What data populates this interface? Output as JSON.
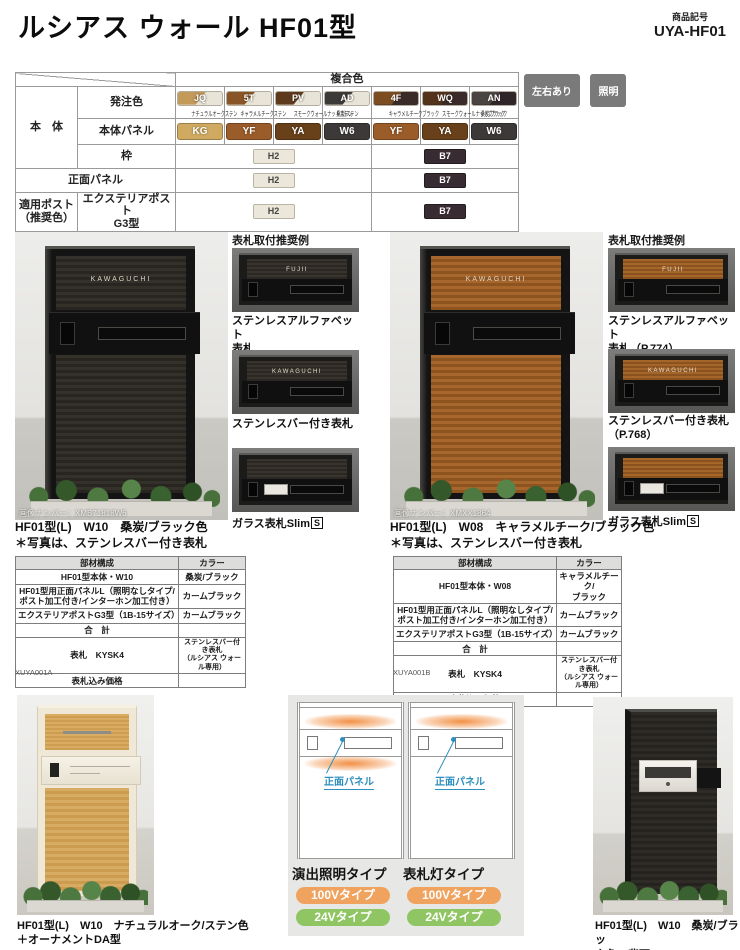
{
  "header": {
    "title": "ルシアス ウォール HF01型",
    "product_code_label": "商品記号",
    "product_code": "UYA-HF01",
    "button_bg": "#7a7a7a",
    "buttons": [
      {
        "label": "左右あり"
      },
      {
        "label": "照明"
      }
    ]
  },
  "color_table": {
    "group_header": "複合色",
    "body_label": "本　体",
    "order_color_label": "発注色",
    "body_panel_label": "本体パネル",
    "frame_label": "枠",
    "front_panel_label": "正面パネル",
    "post_label": "適用ポスト\n（推奨色）",
    "post_name": "エクステリアポスト\nG3型",
    "order_colors": [
      {
        "code": "JQ",
        "label": "ナチュラルオークステン",
        "wood": "#c49a5a",
        "base": "#e8e4d7"
      },
      {
        "code": "5T",
        "label": "キャラメルチークステン",
        "wood": "#8a5526",
        "base": "#e8e4d7"
      },
      {
        "code": "PV",
        "label": "スモークウォールナットステン",
        "wood": "#5d3a1c",
        "base": "#e8e4d7"
      },
      {
        "code": "AD",
        "label": "桑炭/ステン",
        "wood": "#3c3a38",
        "base": "#e8e4d7"
      },
      {
        "code": "4F",
        "label": "キャラメルチークブラック",
        "wood": "#7d4d22",
        "base": "#3a2b28"
      },
      {
        "code": "WQ",
        "label": "スモークウォールナットブラック",
        "wood": "#54331d",
        "base": "#3a2b28"
      },
      {
        "code": "AN",
        "label": "桑炭/ブラック",
        "wood": "#4a4543",
        "base": "#2e2629"
      }
    ],
    "panel_colors": [
      {
        "code": "KG",
        "color": "#d0aa60"
      },
      {
        "code": "YF",
        "color": "#9a5c28"
      },
      {
        "code": "YA",
        "color": "#68401a"
      },
      {
        "code": "W6",
        "color": "#3d3938"
      },
      {
        "code": "YF",
        "color": "#9a5c28"
      },
      {
        "code": "YA",
        "color": "#68401a"
      },
      {
        "code": "W6",
        "color": "#3d3938"
      }
    ],
    "h2": {
      "code": "H2",
      "bg": "#ebe8db",
      "fg": "#444444",
      "border": "#b9b4a4"
    },
    "b7": {
      "code": "B7",
      "bg": "#382b31",
      "fg": "#ffffff",
      "border": "#241b20"
    }
  },
  "recommend_left": {
    "heading": "表札取付推奨例",
    "items": [
      {
        "nameplate": "FUJII",
        "caption": "ステンレスアルファベット\n表札",
        "slim_mark": ""
      },
      {
        "nameplate": "KAWAGUCHI",
        "caption": "ステンレスバー付き表札",
        "slim_mark": ""
      },
      {
        "nameplate": "",
        "caption": "ガラス表札Slim",
        "slim_mark": "S"
      }
    ]
  },
  "recommend_right": {
    "heading": "表札取付推奨例",
    "items": [
      {
        "nameplate": "FUJII",
        "caption": "ステンレスアルファベット\n表札（P.774）",
        "slim_mark": ""
      },
      {
        "nameplate": "KAWAGUCHI",
        "caption": "ステンレスバー付き表札\n（P.768）",
        "slim_mark": ""
      },
      {
        "nameplate": "",
        "caption": "ガラス表札Slim",
        "slim_mark": "S"
      }
    ]
  },
  "product_left": {
    "image_number": "画像ナンバー：XMB71818W6",
    "nameplate": "KAWAGUCHI",
    "caption1": "HF01型(L)　W10　桑炭/ブラック色",
    "caption2": "＊写真は、ステンレスバー付き表札",
    "table_headers": {
      "part": "部材構成",
      "color": "カラー"
    },
    "rows": [
      {
        "part": "HF01型本体・W10",
        "color": "桑炭/ブラック"
      },
      {
        "part": "HF01型用正面パネルL（照明なしタイプ/\nポスト加工付き/インターホン加工付き）",
        "color": "カームブラック"
      },
      {
        "part": "エクステリアポストG3型（1B-15サイズ）",
        "color": "カームブラック"
      },
      {
        "part": "合　計",
        "color": ""
      },
      {
        "part": "表札　KYSK4",
        "color": "ステンレスバー付き表札\n（ルシアス ウォール専用）"
      },
      {
        "part": "表札込み価格",
        "color": ""
      }
    ],
    "doc_code": "XUYA001A"
  },
  "product_right": {
    "image_number": "画像ナンバー：XMXX1864",
    "nameplate": "KAWAGUCHI",
    "caption1": "HF01型(L)　W08　キャラメルチーク/ブラック色",
    "caption2": "＊写真は、ステンレスバー付き表札",
    "table_headers": {
      "part": "部材構成",
      "color": "カラー"
    },
    "rows": [
      {
        "part": "HF01型本体・W08",
        "color": "キャラメルチーク/\nブラック"
      },
      {
        "part": "HF01型用正面パネルL（照明なしタイプ/\nポスト加工付き/インターホン加工付き）",
        "color": "カームブラック"
      },
      {
        "part": "エクステリアポストG3型（1B-15サイズ）",
        "color": "カームブラック"
      },
      {
        "part": "合　計",
        "color": ""
      },
      {
        "part": "表札　KYSK4",
        "color": "ステンレスバー付き表札\n（ルシアス ウォール専用）"
      },
      {
        "part": "表札込み価格",
        "color": ""
      }
    ],
    "doc_code": "XUYA001B"
  },
  "bottom_left": {
    "caption1": "HF01型(L)　W10　ナチュラルオーク/ステン色",
    "caption2": "＋オーナメントDA型"
  },
  "diagrams": {
    "panel_label": "正面パネル",
    "badge1_bg": "#f0a35e",
    "badge2_bg": "#8fc563",
    "types": [
      {
        "name": "演出照明タイプ",
        "badge1": "100Vタイプ",
        "badge2": "24Vタイプ"
      },
      {
        "name": "表札灯タイプ",
        "badge1": "100Vタイプ",
        "badge2": "24Vタイプ"
      }
    ]
  },
  "bottom_right": {
    "caption1": "HF01型(L)　W10　桑炭/ブラッ",
    "caption2": "ク色　背面"
  }
}
